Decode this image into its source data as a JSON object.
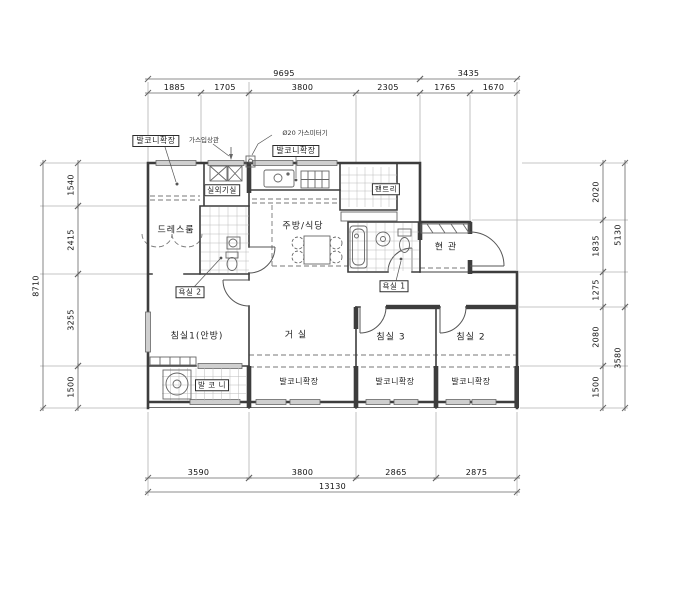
{
  "labels": [
    {
      "name": "label-balcony-ext-topleft",
      "text": "발코니확장",
      "x": 156,
      "y": 141,
      "kind": "boxed"
    },
    {
      "name": "label-gas-riser-note",
      "text": "가스입상관",
      "x": 204,
      "y": 140,
      "kind": "tiny"
    },
    {
      "name": "label-gas-meter-note",
      "text": "Ø20 가스미터기",
      "x": 305,
      "y": 133,
      "kind": "tiny"
    },
    {
      "name": "label-balcony-ext-kitchen",
      "text": "발코니확장",
      "x": 296,
      "y": 151,
      "kind": "boxed"
    },
    {
      "name": "label-outdoor-unit-room",
      "text": "실외기실",
      "x": 222,
      "y": 190,
      "kind": "boxed-sm"
    },
    {
      "name": "label-pantry",
      "text": "팬트리",
      "x": 386,
      "y": 189,
      "kind": "boxed-sm"
    },
    {
      "name": "label-kitchen-dining",
      "text": "주방/식당",
      "x": 303,
      "y": 227,
      "kind": "room"
    },
    {
      "name": "label-dress-room",
      "text": "드레스룸",
      "x": 176,
      "y": 231,
      "kind": "room"
    },
    {
      "name": "label-entrance",
      "text": "현 관",
      "x": 446,
      "y": 248,
      "kind": "room"
    },
    {
      "name": "label-bath2",
      "text": "욕실 2",
      "x": 190,
      "y": 292,
      "kind": "boxed-sm"
    },
    {
      "name": "label-bath1",
      "text": "욕실 1",
      "x": 394,
      "y": 286,
      "kind": "boxed-sm"
    },
    {
      "name": "label-bedroom1",
      "text": "침실1(안방)",
      "x": 197,
      "y": 337,
      "kind": "room"
    },
    {
      "name": "label-living",
      "text": "거 실",
      "x": 296,
      "y": 336,
      "kind": "room"
    },
    {
      "name": "label-bedroom3",
      "text": "침실 3",
      "x": 391,
      "y": 338,
      "kind": "room"
    },
    {
      "name": "label-bedroom2",
      "text": "침실 2",
      "x": 471,
      "y": 338,
      "kind": "room"
    },
    {
      "name": "label-balcony",
      "text": "발 코 니",
      "x": 212,
      "y": 385,
      "kind": "boxed-sm"
    },
    {
      "name": "label-balcony-ext-living",
      "text": "발코니확장",
      "x": 299,
      "y": 382,
      "kind": "room-sm"
    },
    {
      "name": "label-balcony-ext-bed3",
      "text": "발코니확장",
      "x": 395,
      "y": 382,
      "kind": "room-sm"
    },
    {
      "name": "label-balcony-ext-bed2",
      "text": "발코니확장",
      "x": 471,
      "y": 382,
      "kind": "room-sm"
    }
  ],
  "dimensions": {
    "top_outer": {
      "axis": "h",
      "line": 79,
      "items": [
        {
          "value": "9695",
          "from": 148,
          "to": 420
        },
        {
          "value": "3435",
          "from": 420,
          "to": 517
        }
      ]
    },
    "top_inner": {
      "axis": "h",
      "line": 93,
      "items": [
        {
          "value": "1885",
          "from": 148,
          "to": 201
        },
        {
          "value": "1705",
          "from": 201,
          "to": 249
        },
        {
          "value": "3800",
          "from": 249,
          "to": 356
        },
        {
          "value": "2305",
          "from": 356,
          "to": 420
        },
        {
          "value": "1765",
          "from": 420,
          "to": 470
        },
        {
          "value": "1670",
          "from": 470,
          "to": 517
        }
      ]
    },
    "bottom_inner": {
      "axis": "h",
      "line": 478,
      "items": [
        {
          "value": "3590",
          "from": 148,
          "to": 249
        },
        {
          "value": "3800",
          "from": 249,
          "to": 356
        },
        {
          "value": "2865",
          "from": 356,
          "to": 436
        },
        {
          "value": "2875",
          "from": 436,
          "to": 517
        }
      ]
    },
    "bottom_outer": {
      "axis": "h",
      "line": 492,
      "items": [
        {
          "value": "13130",
          "from": 148,
          "to": 517
        }
      ]
    },
    "left_outer": {
      "axis": "v",
      "line": 43,
      "items": [
        {
          "value": "8710",
          "from": 163,
          "to": 408
        }
      ]
    },
    "left_inner": {
      "axis": "v",
      "line": 78,
      "items": [
        {
          "value": "1540",
          "from": 163,
          "to": 206
        },
        {
          "value": "2415",
          "from": 206,
          "to": 274
        },
        {
          "value": "3255",
          "from": 274,
          "to": 366
        },
        {
          "value": "1500",
          "from": 366,
          "to": 408
        }
      ]
    },
    "right_inner": {
      "axis": "v",
      "line": 603,
      "items": [
        {
          "value": "2020",
          "from": 163,
          "to": 220
        },
        {
          "value": "1835",
          "from": 220,
          "to": 272
        },
        {
          "value": "1275",
          "from": 272,
          "to": 307
        },
        {
          "value": "2080",
          "from": 307,
          "to": 366
        },
        {
          "value": "1500",
          "from": 366,
          "to": 408
        }
      ]
    },
    "right_outer": {
      "axis": "v",
      "line": 625,
      "items": [
        {
          "value": "5130",
          "from": 163,
          "to": 307
        },
        {
          "value": "3580",
          "from": 307,
          "to": 408
        }
      ]
    }
  },
  "colors": {
    "wall": "#3d3d3d",
    "dim_line": "#666666",
    "extension_line": "#b3b3b3",
    "window_fill": "#cfcfcf",
    "background": "#ffffff"
  }
}
